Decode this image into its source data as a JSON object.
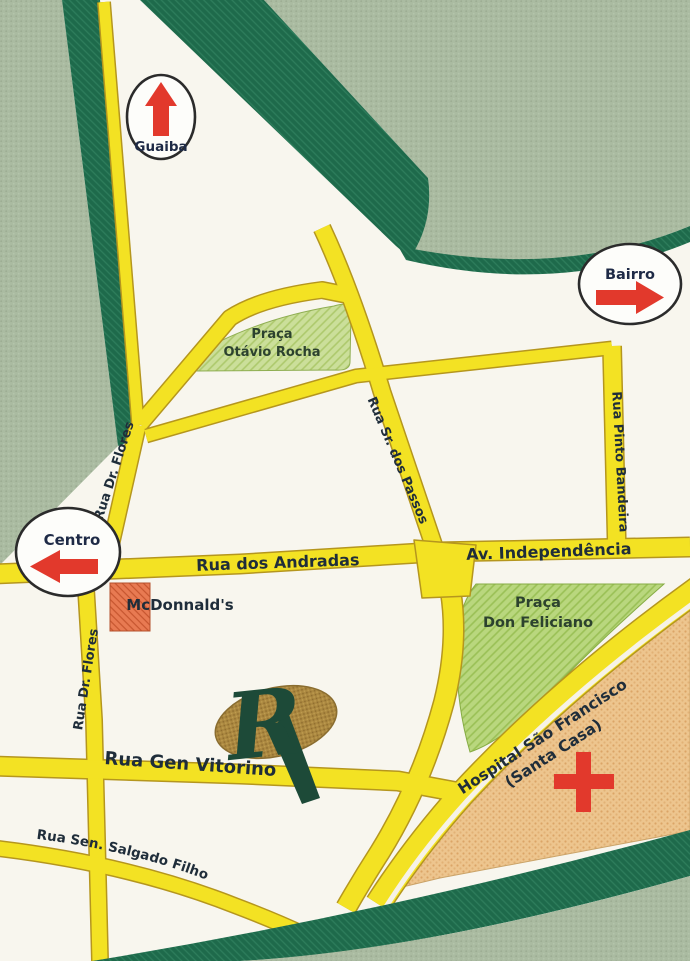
{
  "signs": {
    "guaiba": "Guaiba",
    "bairro": "Bairro",
    "centro": "Centro"
  },
  "streets": {
    "dr_flores": "Rua Dr. Flores",
    "sr_dos_passos": "Rua Sr. dos Passos",
    "pinto_bandeira": "Rua Pinto Bandeira",
    "andradas": "Rua dos Andradas",
    "independencia": "Av. Independência",
    "gen_vitorino": "Rua Gen Vitorino",
    "salgado_filho": "Rua Sen. Salgado Filho"
  },
  "places": {
    "praca_otavio_rocha_line1": "Praça",
    "praca_otavio_rocha_line2": "Otávio Rocha",
    "praca_don_feliciano_line1": "Praça",
    "praca_don_feliciano_line2": "Don Feliciano",
    "hospital_line1": "Hospital São Francisco",
    "hospital_line2": "(Santa Casa)",
    "mcdonalds": "McDonnald's",
    "logo_letter": "R"
  },
  "colors": {
    "street_yellow": "#f3e223",
    "street_outline": "#b5961e",
    "map_white": "#f8f6ee",
    "dark_green_band": "#1e6a4b",
    "sage_background": "#aabba1",
    "praca_green": "#cbdf9a",
    "feliciano_green": "#b9d77e",
    "hospital_orange": "#edc58e",
    "mcdonalds_red": "#e87a52",
    "arrow_red": "#e2392c",
    "cross_red": "#e2392c",
    "logo_gold": "#ab8840",
    "logo_green": "#1d4a38",
    "label_dark": "#1f2d3a"
  }
}
